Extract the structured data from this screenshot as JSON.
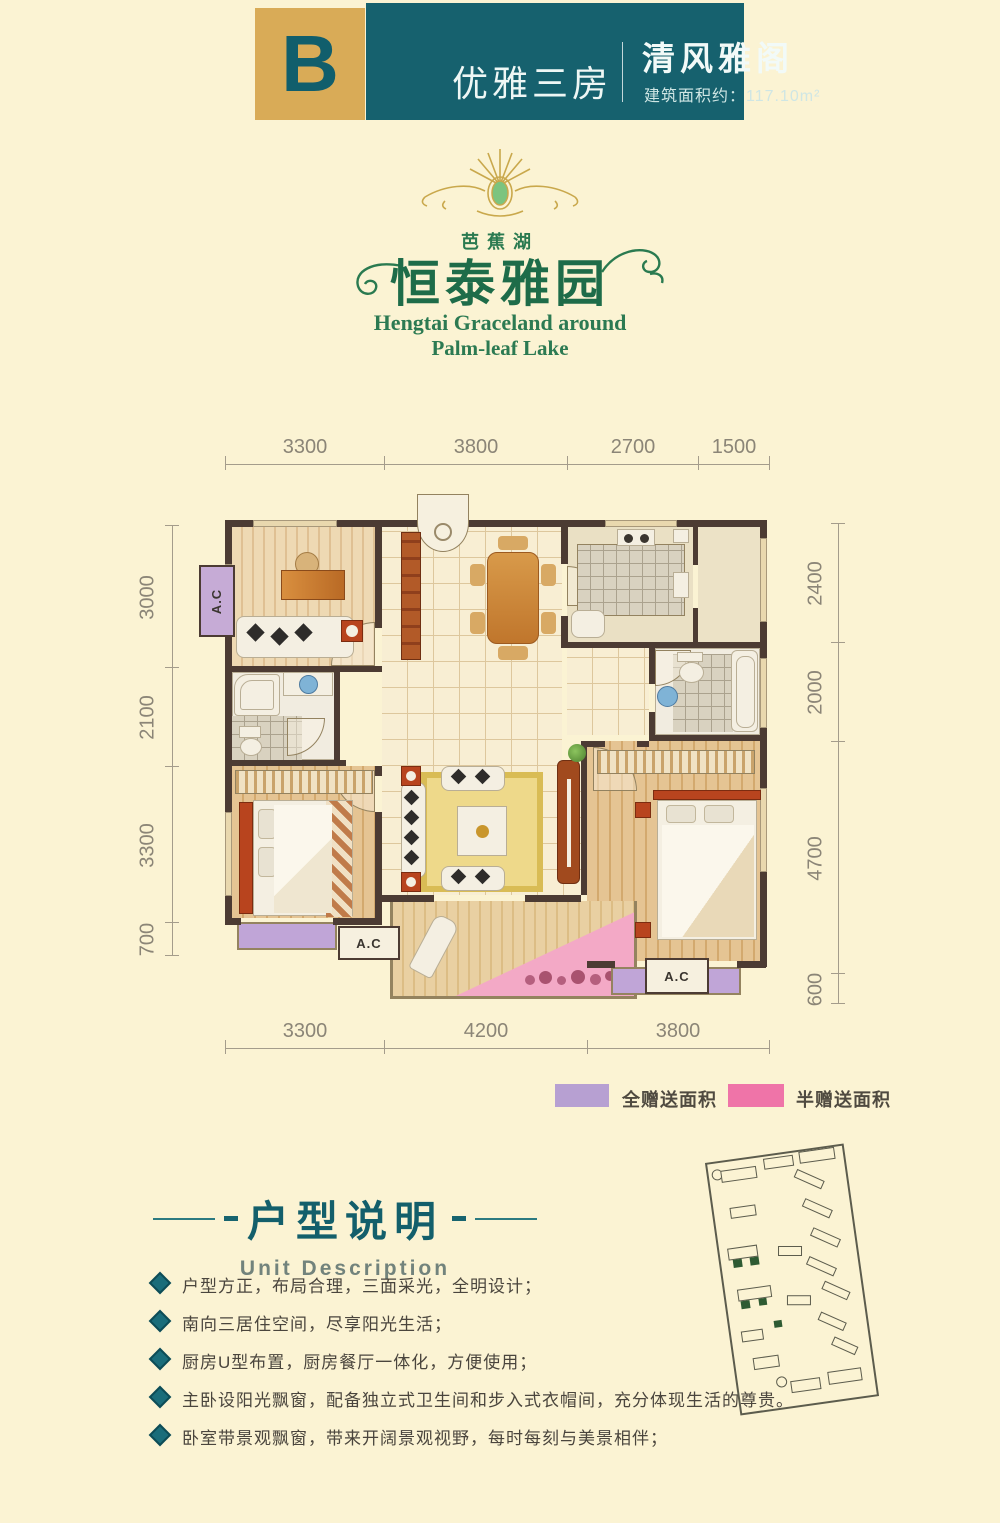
{
  "header": {
    "letter": "B",
    "unit_type": "优雅三房",
    "unit_name": "清风雅阁",
    "area": "建筑面积约：117.10m²",
    "teal": "#16616e",
    "gold": "#d9ab57"
  },
  "logo": {
    "lake": "芭蕉湖",
    "name": "恒泰雅园",
    "en1": "Hengtai Graceland around",
    "en2": "Palm-leaf Lake",
    "green": "#1e6c49"
  },
  "plan": {
    "ac": "A.C",
    "dims": {
      "top": [
        "3300",
        "3800",
        "2700",
        "1500"
      ],
      "left": [
        "3000",
        "2100",
        "3300",
        "700"
      ],
      "right": [
        "2400",
        "2000",
        "4700",
        "600"
      ],
      "bottom": [
        "3300",
        "4200",
        "3800"
      ]
    }
  },
  "legend": {
    "full": "全赠送面积",
    "full_color": "#b7a0d2",
    "half": "半赠送面积",
    "half_color": "#ef74a8"
  },
  "desc": {
    "title": "户型说明",
    "subtitle": "Unit Description",
    "bullets": [
      "户型方正，布局合理，三面采光，全明设计；",
      "南向三居住空间，尽享阳光生活；",
      "厨房U型布置，厨房餐厅一体化，方便使用；",
      "主卧设阳光飘窗，配备独立式卫生间和步入式衣帽间，充分体现生活的尊贵。",
      "卧室带景观飘窗，带来开阔景观视野，每时每刻与美景相伴；"
    ]
  }
}
